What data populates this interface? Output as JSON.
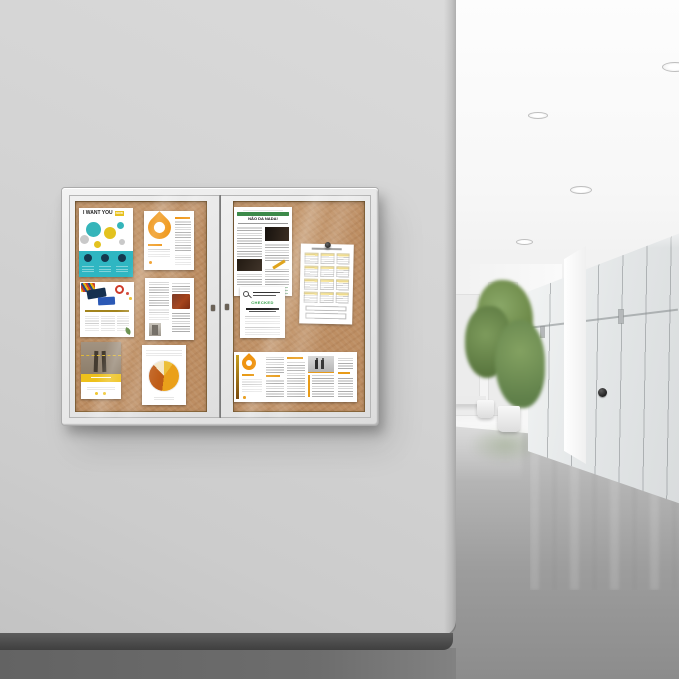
{
  "scene": {
    "subject": "Two-door enclosed cork bulletin board mounted on a gray wall",
    "environment": "Bright modern office hallway with glass partitions, potted plants and recessed ceiling lights",
    "palette": {
      "wall": "#d2d2d2",
      "cork": "#bd8e63",
      "frame": "#e8e8e8",
      "hall_floor": "#9d9d9d",
      "baseboard": "#4a4a4a",
      "plant_green": "#6c8a4e"
    }
  },
  "board": {
    "door_count": 2,
    "lock_count": 2,
    "posters": {
      "want_you": {
        "title": "I WANT YOU",
        "badge": "NOW",
        "accent": "#2fb6c2"
      },
      "drop_flyer": {
        "accent": "#ef9412"
      },
      "cards_flyer": {
        "accent": "#cf3b2a"
      },
      "legs_flyer": {
        "accent": "#eec11b"
      },
      "pie_report": {
        "slice_colors": [
          "#eaa01a",
          "#bf5c17",
          "#f4e7c8",
          "#ecbf3a"
        ]
      },
      "newsletter": {
        "headline": "NÃO DA NADA!",
        "accent": "#3d8a4a"
      },
      "calendar": {
        "pin": "black push pin",
        "highlight": "#f4d65c"
      },
      "notice": {
        "status": "CHECKED",
        "status_color": "#2f9e44"
      },
      "brochure": {
        "accent": "#e89b18"
      }
    }
  },
  "hallway": {
    "ceiling_lights": 5,
    "plants": 2,
    "door_handle_color": "#2b2b2b"
  },
  "icons": {
    "push_pin": "round black push pin",
    "magnifier": "magnifying glass",
    "drop_logo": "orange water-drop logo",
    "lock": "door lock keyhole",
    "door_handle": "round black knob"
  }
}
